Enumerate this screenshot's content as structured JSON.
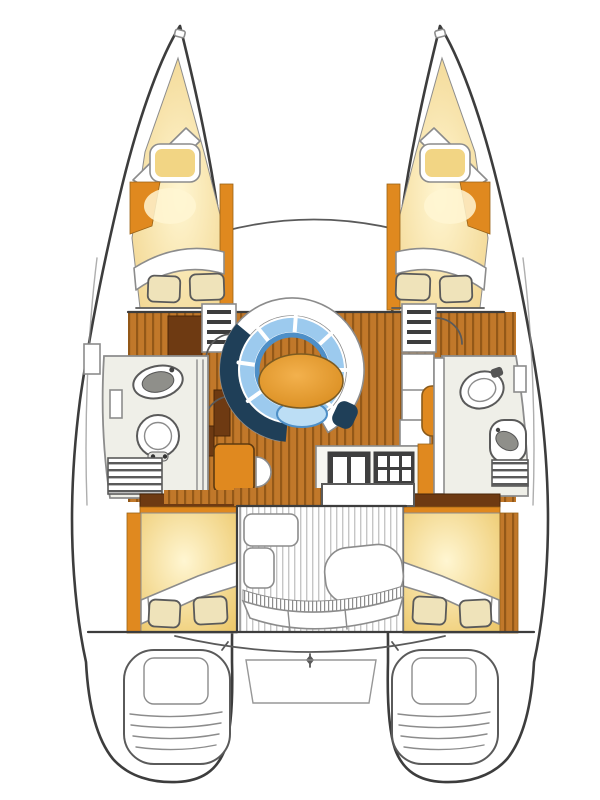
{
  "figure": "catamaran-interior-floor-plan",
  "view": "top-down-deck-plan",
  "colors": {
    "white": "#ffffff",
    "outline": "#3d3d3d",
    "line_mid": "#5a5a5a",
    "line_soft": "#8c8c8c",
    "wood": "#c1782a",
    "wood_dark": "#935818",
    "orange_strip": "#e0891f",
    "dark_cabinet": "#6e3a12",
    "berth_yellow": "#f2d584",
    "bed_center": "#fff6d2",
    "bed_edge": "#edc96d",
    "berth_edge": "#f0d186",
    "pillow_cream": "#efe3ba",
    "room_floor": "#efefe8",
    "fixture_gray": "#8f8f8a",
    "sofa_navy": "#1f3f58",
    "sofa_cushion": "#9ccaee",
    "sofa_rim": "#4e8fc7",
    "stool_blue": "#bcdef5",
    "table_hi": "#f3b14d",
    "table_lo": "#d98d20",
    "appliance_dark": "#3f3f3f",
    "deck_stripe": "#c6c6c6",
    "counter_white": "#f7f7f2"
  },
  "areas": [
    {
      "id": "port-hull",
      "kind": "hull"
    },
    {
      "id": "starboard-hull",
      "kind": "hull"
    },
    {
      "id": "port-bow-berth",
      "kind": "v-berth"
    },
    {
      "id": "starboard-bow-berth",
      "kind": "v-berth"
    },
    {
      "id": "port-forward-cabin",
      "kind": "double-berth"
    },
    {
      "id": "starboard-forward-cabin",
      "kind": "double-berth"
    },
    {
      "id": "port-head",
      "kind": "bathroom"
    },
    {
      "id": "starboard-head",
      "kind": "bathroom"
    },
    {
      "id": "salon",
      "kind": "settee-and-table"
    },
    {
      "id": "nav-station",
      "kind": "chart-table"
    },
    {
      "id": "galley",
      "kind": "sink-and-stove"
    },
    {
      "id": "cockpit",
      "kind": "bench-seating"
    },
    {
      "id": "port-aft-cabin",
      "kind": "double-berth"
    },
    {
      "id": "starboard-aft-cabin",
      "kind": "double-berth"
    },
    {
      "id": "port-transom-steps",
      "kind": "swim-steps"
    },
    {
      "id": "starboard-transom-steps",
      "kind": "swim-steps"
    }
  ]
}
